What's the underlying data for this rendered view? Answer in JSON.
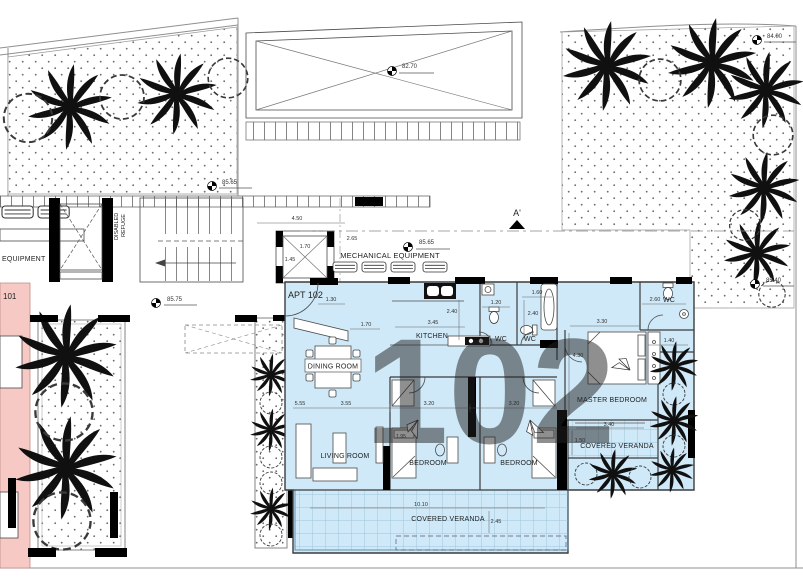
{
  "watermark": "102",
  "apartments": {
    "current": "APT 102",
    "neighbor": "101"
  },
  "rooms": {
    "kitchen": "KITCHEN",
    "dining": "DINING ROOM",
    "living": "LIVING ROOM",
    "bedroom_a": "BEDROOM",
    "bedroom_b": "BEDROOM",
    "master": "MASTER BEDROOM",
    "wc_a": "WC",
    "wc_b": "WC",
    "wc_master": "WC",
    "veranda_main": "COVERED VERANDA",
    "veranda_master": "COVERED VERANDA"
  },
  "core": {
    "mechanical": "MECHANICAL EQUIPMENT",
    "equipment_left": "EQUIPMENT",
    "disabled": "DISABLED",
    "refuge": "REFUGE",
    "section_marker": "A'"
  },
  "levels": {
    "roof": "82.70",
    "garden_nw": "85.65",
    "landing": "85.75",
    "core": "85.65",
    "garden_ne": "84.00",
    "garden_e": "85.40"
  },
  "dims": {
    "core_width": "4.50",
    "core_offset": "2.65",
    "lift_w": "1.70",
    "lift_d": "1.45",
    "entry_a": "1.30",
    "entry_b": "1.70",
    "kitchen_w": "3.45",
    "kitchen_d": "2.40",
    "wc_a_w": "1.20",
    "wc_b_d": "2.40",
    "wc_b_w": "1.60",
    "wc_master_w": "2.60",
    "master_w": "3.30",
    "master_d": "4.30",
    "wardrobe_d": "1.40",
    "veranda_master_w": "3.40",
    "veranda_master_d": "1.50",
    "living_total": "5.55",
    "living_w": "3.55",
    "bedroom_a_w": "3.20",
    "bedroom_b_w": "3.20",
    "bed_len": "1.95",
    "veranda_main_w": "10.10",
    "veranda_main_d": "2.45"
  },
  "colors": {
    "apartment_fill": "#cfe9f8",
    "neighbor_fill": "#f6c9c5",
    "watermark": "#5f8cc4"
  }
}
